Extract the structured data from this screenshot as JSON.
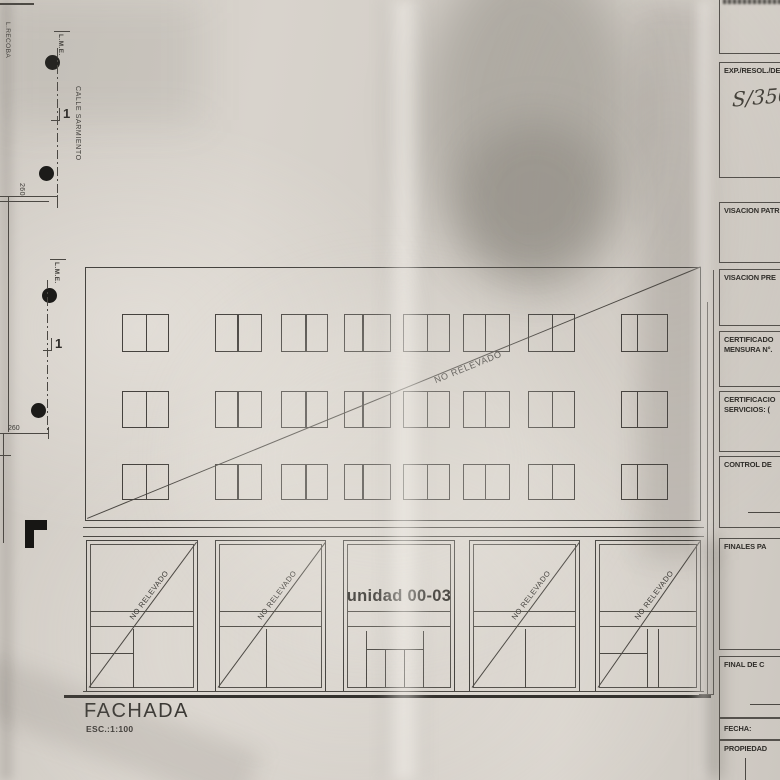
{
  "site_plan": {
    "boundary_label": "L.RECOBA",
    "lme_label_upper": "L.M.E.",
    "lme_label_lower": "L.M.E.",
    "street_label": "CALLE SARMIENTO",
    "dim_upper": "260",
    "dim_lower": "260",
    "axis_marker_upper": "1",
    "axis_marker_lower": "1"
  },
  "facade": {
    "main_overlay": "NO RELEVADO",
    "bay_overlay": "NO RELEVADO",
    "unit_label": "unidad 00-03",
    "title": "FACHADA",
    "scale": "ESC.:1:100"
  },
  "title_block": {
    "exp_label": "EXP./RESOL./DEC",
    "exp_value": "S/350",
    "visacion_patr": "VISACION PATR",
    "visacion_pre": "VISACION PRE",
    "cert_mensura_1": "CERTIFICADO",
    "cert_mensura_2": "MENSURA N°.",
    "cert_serv_1": "CERTIFICACIO",
    "cert_serv_2": "SERVICIOS: (",
    "control": "CONTROL DE",
    "finales": "FINALES PA",
    "final_obra": "FINAL DE C",
    "fecha": "FECHA:",
    "propiedad": "PROPIEDAD"
  }
}
